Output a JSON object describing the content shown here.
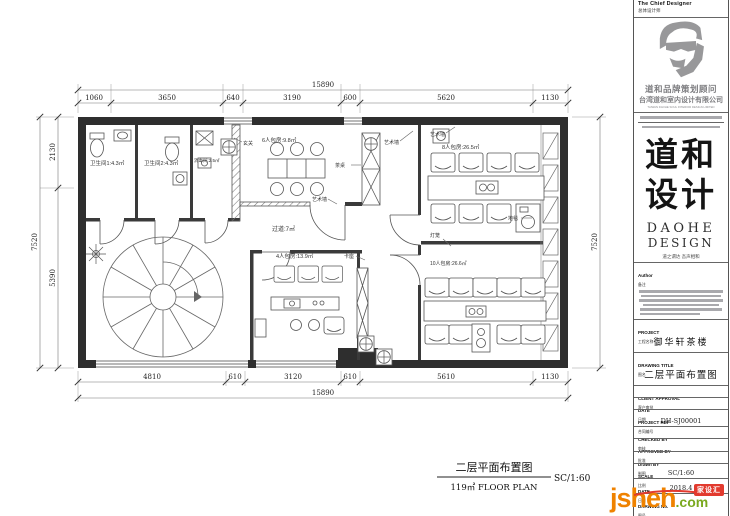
{
  "plan": {
    "dims": {
      "top_total": "15890",
      "top_segments": [
        "1060",
        "3650",
        "640",
        "3190",
        "600",
        "5620",
        "1130"
      ],
      "bottom_segments": [
        "4810",
        "610",
        "3120",
        "610",
        "5610",
        "1130"
      ],
      "bottom_total": "15890",
      "left_segments": [
        "2130",
        "5390"
      ],
      "left_total": "7520",
      "right_total": "7520"
    },
    "rooms": {
      "wc1": "卫生间1:4.3㎡",
      "wc2": "卫生间2:4.3㎡",
      "sterilize": "消毒间:2.5㎡",
      "room6": "6人包房:9.8㎡",
      "room8": "8人包房:26.5㎡",
      "corridor": "过道:7㎡",
      "room4": "4人包房:13.9㎡",
      "room10": "10人包房:26.6㎡"
    },
    "annotations": {
      "art_wall": "艺术墙",
      "tea_table": "茶桌",
      "carpet": "地毯",
      "lantern": "灯笼",
      "booth": "卡座",
      "foyer": "玄关"
    }
  },
  "footer": {
    "plan_title": "二层平面布置图",
    "plan_area": "119㎡  FLOOR PLAN",
    "scale": "SC/1:60"
  },
  "titleblock": {
    "chief_en": "The Chief Designer",
    "chief_cn": "总体设计师",
    "brand_line1": "道和品牌策划顾问",
    "brand_line2": "台湾道和室内设计有限公司",
    "brand_en": "TAIWAN DAOHE SOUL INTERIOR DESIGN LIMITED",
    "logo_cn_1": "道和",
    "logo_cn_2": "设计",
    "logo_en_1": "DAOHE",
    "logo_en_2": "DESIGN",
    "slogan": "道之谓达  吾声相和",
    "author_label": "Author",
    "author_label_cn": "备注",
    "project_label": "PROJECT",
    "project_label_cn": "工程名称",
    "project_value": "御华轩茶楼",
    "drawing_title_label": "DRAWING TITLE",
    "drawing_title_label_cn": "图名",
    "drawing_title_value": "二层平面布置图",
    "rows": [
      {
        "en": "CLIENT APPROVAL",
        "cn": "客户审批",
        "value": ""
      },
      {
        "en": "DATE",
        "cn": "日期",
        "value": ""
      },
      {
        "en": "PROJECT REF",
        "cn": "合同编号",
        "value": "DH-SJ00001"
      },
      {
        "en": "CHECKED BY",
        "cn": "审核",
        "value": ""
      },
      {
        "en": "APPROVED BY",
        "cn": "批准",
        "value": ""
      },
      {
        "en": "Drawn BY",
        "cn": "制图",
        "value": ""
      },
      {
        "en": "SCALE",
        "cn": "比例",
        "value": "SC/1:60"
      },
      {
        "en": "DATE",
        "cn": "日期",
        "value": "2018.4"
      },
      {
        "en": "DRAWING No.",
        "cn": "图号",
        "value": ""
      }
    ]
  },
  "watermark": {
    "name": "jsheh",
    "tld": ".com",
    "badge": "家设汇"
  },
  "colors": {
    "wall": "#2e2e2e",
    "accent_orange": "#ef8200",
    "accent_green": "#7aa91f",
    "badge_red": "#e23a2e"
  }
}
